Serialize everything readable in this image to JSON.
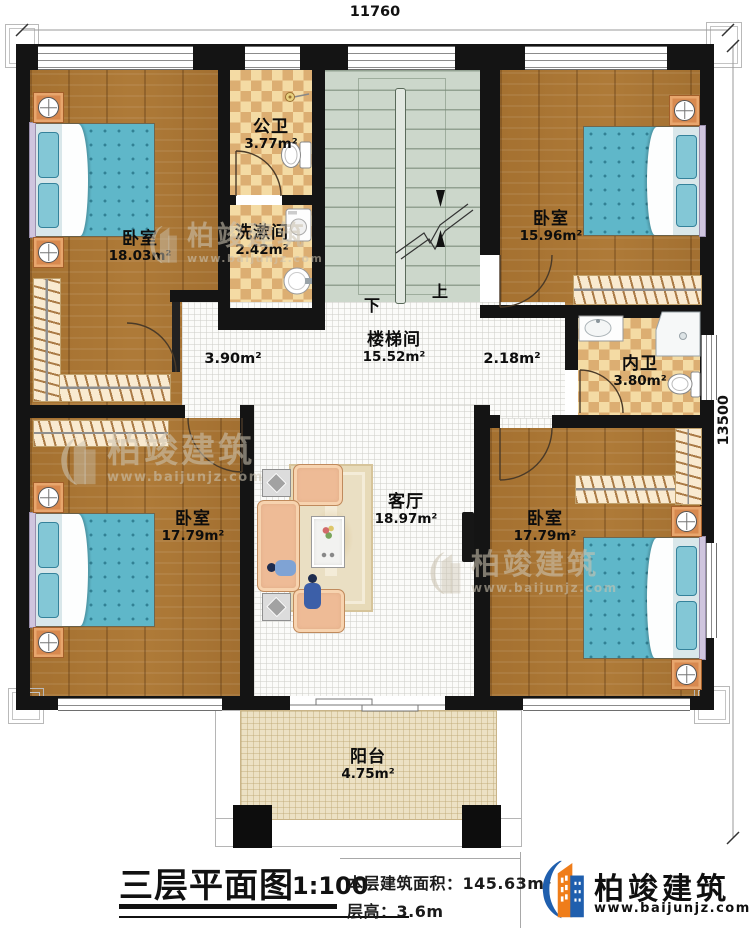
{
  "plan": {
    "dim_top": "11760",
    "dim_right": "13500",
    "rooms": {
      "bedroom_tl": {
        "name": "卧室",
        "area": "18.03m²"
      },
      "public_bath": {
        "name": "公卫",
        "area": "3.77m²"
      },
      "washroom": {
        "name": "洗漱间",
        "area": "2.42m²"
      },
      "stairwell": {
        "name": "楼梯间",
        "area": "15.52m²"
      },
      "bedroom_tr": {
        "name": "卧室",
        "area": "15.96m²"
      },
      "inner_bath": {
        "name": "内卫",
        "area": "3.80m²"
      },
      "hall_left": {
        "area": "3.90m²"
      },
      "hall_right": {
        "area": "2.18m²"
      },
      "living": {
        "name": "客厅",
        "area": "18.97m²"
      },
      "bedroom_bl": {
        "name": "卧室",
        "area": "17.79m²"
      },
      "bedroom_br": {
        "name": "卧室",
        "area": "17.79m²"
      },
      "balcony": {
        "name": "阳台",
        "area": "4.75m²"
      }
    },
    "stairs": {
      "down": "下",
      "up": "上"
    }
  },
  "titleblock": {
    "title": "三层平面图",
    "scale": "1:100",
    "floor_area": "本层建筑面积：145.63m²",
    "floor_height": "层高：3.6m"
  },
  "brand": {
    "name": "柏竣建筑",
    "url": "www.baijunjz.com"
  },
  "watermark": {
    "name": "柏竣建筑",
    "url": "www.baijunjz.com"
  },
  "colors": {
    "wall": "#141414",
    "wood": "#ad7a38",
    "tile_light": "#f4dba4",
    "tile_dark": "#dcae72",
    "stair_floor": "#ccd7cb",
    "bed_blanket": "#5fb7c9",
    "sofa": "#eebb96",
    "brand_blue": "#1f5fae",
    "brand_orange": "#ef7d1a"
  }
}
